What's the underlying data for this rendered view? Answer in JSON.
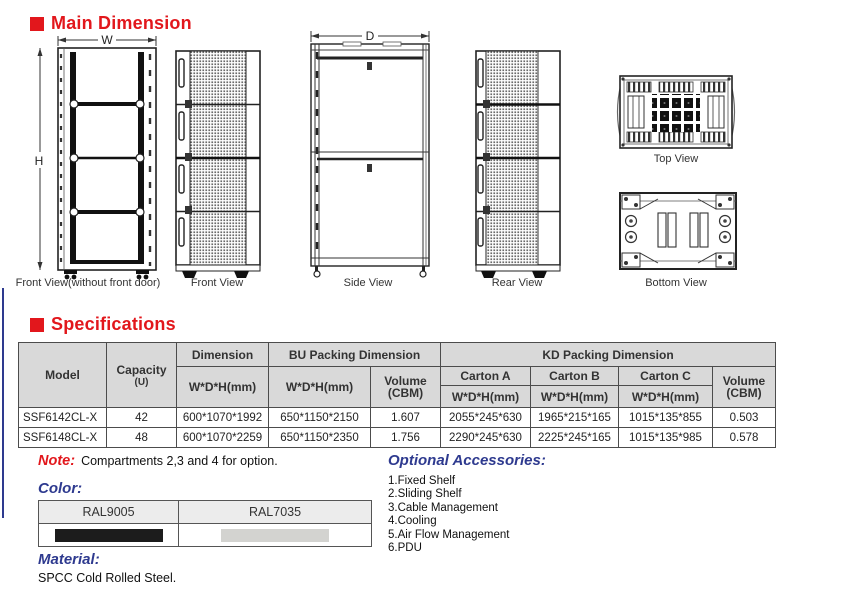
{
  "headings": {
    "main_dimension": "Main Dimension",
    "specifications": "Specifications"
  },
  "views": {
    "front_no_door_label": "Front View(without front door)",
    "front_label": "Front View",
    "side_label": "Side View",
    "rear_label": "Rear View",
    "top_label": "Top View",
    "bottom_label": "Bottom View",
    "dim_w": "W",
    "dim_h": "H",
    "dim_d": "D"
  },
  "spec_table": {
    "headers": {
      "model": "Model",
      "capacity": "Capacity",
      "capacity_unit": "(U)",
      "dimension": "Dimension",
      "bu_packing": "BU Packing Dimension",
      "kd_packing": "KD Packing Dimension",
      "wdh": "W*D*H(mm)",
      "volume_line1": "Volume",
      "volume_line2": "(CBM)",
      "carton_a": "Carton A",
      "carton_b": "Carton B",
      "carton_c": "Carton C"
    },
    "rows": [
      {
        "model": "SSF6142CL-X",
        "capacity": "42",
        "dim_wdh": "600*1070*1992",
        "bu_wdh": "650*1150*2150",
        "bu_volume": "1.607",
        "carton_a": "2055*245*630",
        "carton_b": "1965*215*165",
        "carton_c": "1015*135*855",
        "kd_volume": "0.503"
      },
      {
        "model": "SSF6148CL-X",
        "capacity": "48",
        "dim_wdh": "600*1070*2259",
        "bu_wdh": "650*1150*2350",
        "bu_volume": "1.756",
        "carton_a": "2290*245*630",
        "carton_b": "2225*245*165",
        "carton_c": "1015*135*985",
        "kd_volume": "0.578"
      }
    ]
  },
  "note": {
    "label": "Note:",
    "text": "Compartments 2,3 and 4 for option."
  },
  "color_section": {
    "label": "Color:",
    "swatches": [
      {
        "name": "RAL9005",
        "hex": "#1c1c1c"
      },
      {
        "name": "RAL7035",
        "hex": "#d3d3d0"
      }
    ]
  },
  "material_section": {
    "label": "Material:",
    "text": "SPCC Cold Rolled Steel."
  },
  "accessories": {
    "label": "Optional Accessories:",
    "items": [
      "1.Fixed Shelf",
      "2.Sliding Shelf",
      "3.Cable Management",
      "4.Cooling",
      "5.Air Flow Management",
      "6.PDU"
    ]
  },
  "colors": {
    "accent_red": "#e2171c",
    "heading_blue": "#2e3a8f",
    "table_header_bg": "#d9d9d9"
  }
}
